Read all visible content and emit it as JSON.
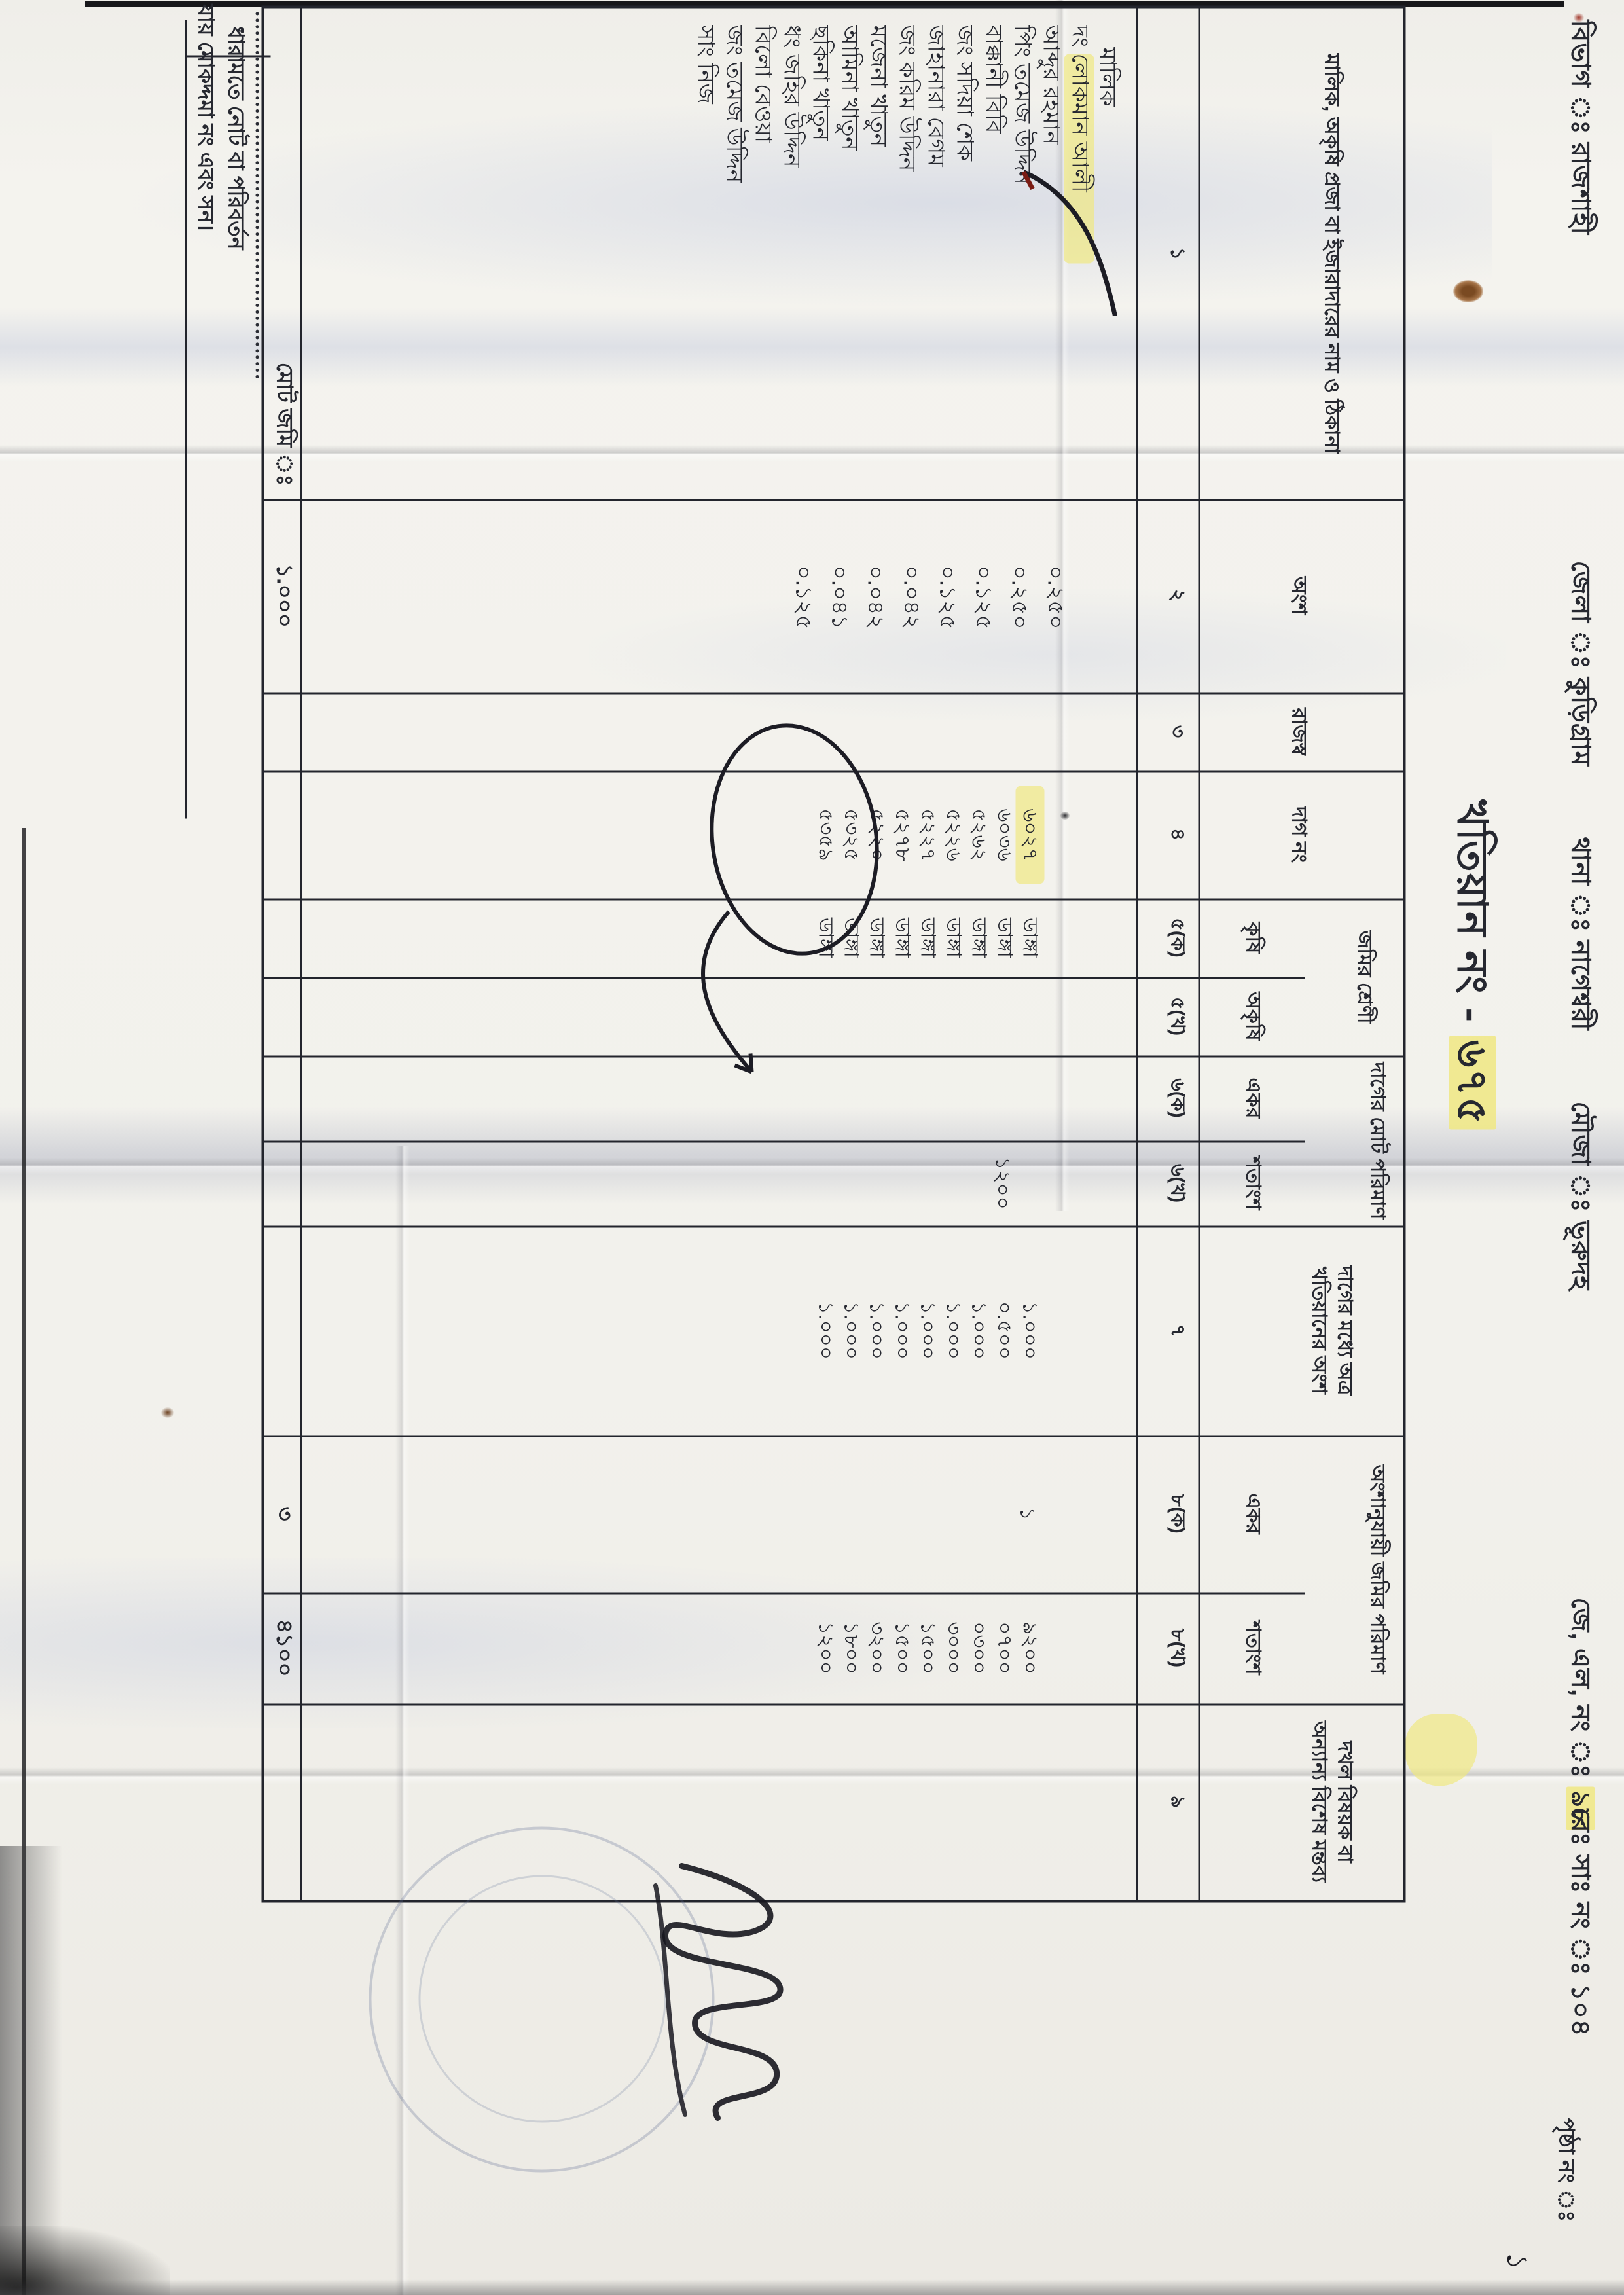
{
  "header": {
    "division_label": "বিভাগ ঃ",
    "division": "রাজশাহী",
    "district_label": "জেলা ঃ",
    "district": "কুড়িগ্রাম",
    "thana_label": "থানা ঃ",
    "thana": "নাগেশ্বরী",
    "mouza_label": "মৌজা ঃ",
    "mouza": "ভূরুদহ",
    "jl_label": "জে, এল, নং ঃ",
    "jl_number": "৯৮",
    "re_sa_label": "রেঃ সাঃ নং ঃ",
    "re_sa_number": "১০৪"
  },
  "title": {
    "prefix": "খতিয়ান নং - ",
    "number": "৬৭৫"
  },
  "page": {
    "label": "পৃষ্ঠা নং ঃ",
    "handwritten_mark": "১"
  },
  "table": {
    "col1_label": "মালিক, অকৃষি প্রজা বা ইজারাদারের নাম ও ঠিকানা",
    "col2_label": "অংশ",
    "col3_label": "রাজস্ব",
    "col4_label": "দাগ নং",
    "col5_group": "জমির শ্রেণী",
    "col5a_label": "কৃষি",
    "col5b_label": "অকৃষি",
    "col6_group": "দাগের মোট পরিমাণ",
    "col6a_label": "একর",
    "col6b_label": "শতাংশ",
    "col7_label": "দাগের মধ্যে অত্র খতিয়ানের অংশ",
    "col8_group": "অংশানুযায়ী জমির পরিমাণ",
    "col8a_label": "একর",
    "col8b_label": "শতাংশ",
    "col9_label": "দখল বিষয়ক বা অন্যান্য বিশেষ মন্তব্য",
    "col_numbers": [
      "১",
      "২",
      "৩",
      "৪",
      "৫(ক)",
      "৫(খ)",
      "৬(ক)",
      "৬(খ)",
      "৭",
      "৮(ক)",
      "৮(খ)",
      "৯"
    ],
    "owner_heading": "মালিক",
    "owners": [
      "দং লোকমান আলী",
      "আব্দুর রহমান",
      "পিং তমেজ উদ্দিন",
      "বাক্কানী বিবি",
      "জং সদিয়া শেক",
      "জাহানারা বেগম",
      "জং করিম উদ্দিন",
      "মজেনা খাতুন",
      "আমিনা খাতুন",
      "ছকিনা খাতুন",
      "ধং জহির উদ্দিন",
      "বিলো বেওয়া",
      "জং তমেজ উদ্দিন",
      "সাং নিজ"
    ],
    "shares": [
      "০.২৫০",
      "০.২৫০",
      "০.১২৫",
      "০.১২৫",
      "০.০৪২",
      "০.০৪২",
      "০.০৪১",
      "০.১২৫"
    ],
    "dag_numbers": [
      "৬০২৭",
      "৬০৩৬",
      "৫২৬২",
      "৫২২৬",
      "৫২২৭",
      "৫২৭৮",
      "৫২২০",
      "৫৩২৫",
      "৫৩৫৯"
    ],
    "land_classes": [
      "ডাঙ্গা",
      "ডাঙ্গা",
      "ডাঙ্গা",
      "ডাঙ্গা",
      "ডাঙ্গা",
      "ডাঙ্গা",
      "ডাঙ্গা",
      "ডাঙ্গা",
      "ডাঙ্গা"
    ],
    "plot_total_amount_row2": "১২০০",
    "khatian_share_values": [
      "১.০০০",
      "০.৫০০",
      "১.০০০",
      "১.০০০",
      "১.০০০",
      "১.০০০",
      "১.০০০",
      "১.০০০",
      "১.০০০"
    ],
    "acre_value_row1": "১",
    "shotangsho_values": [
      "৯২০০",
      "০৭০০",
      "০৩০০",
      "৩০০০",
      "১৫০০",
      "১৫০০",
      "৩২০০",
      "১৮০০",
      "১২০০"
    ],
    "totals": {
      "label": "মোট জমি ঃ",
      "share_total": "১.০০০",
      "acre_total": "৩",
      "shotangsho_total": "৪১০০"
    }
  },
  "footer": {
    "line1": "ধারামতে নোট বা পরিবর্তন",
    "line2": "যায় মোকদ্দমা নং এবং সন।"
  }
}
